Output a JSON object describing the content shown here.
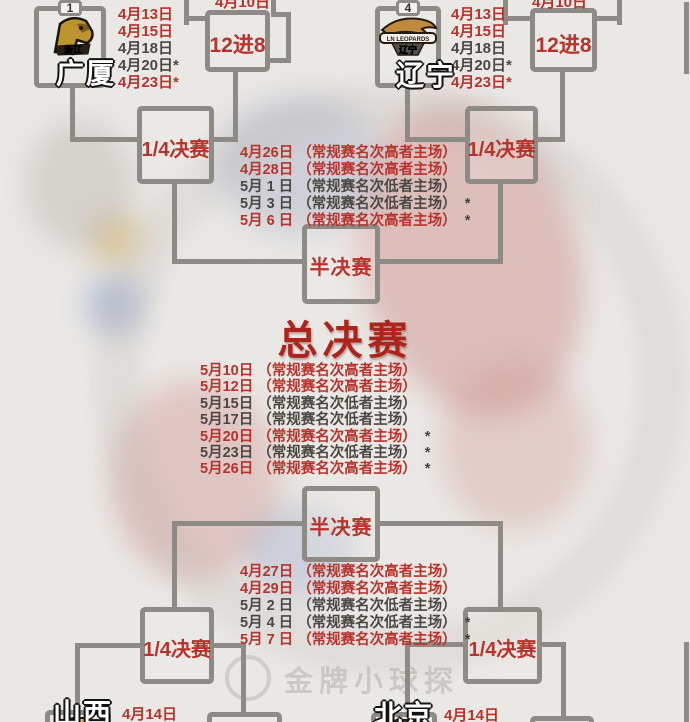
{
  "colors": {
    "red": "#b7332b",
    "dark": "#4b4743",
    "line": "#8e8a85",
    "bg": "#eae8e5",
    "final_red": "#ad241c"
  },
  "rounds": {
    "r12": "12进8",
    "qf": "1/4决赛",
    "sf": "半决赛",
    "final": "总决赛"
  },
  "top_left": {
    "seed": "1",
    "team": "广厦",
    "logo_text": "浙江",
    "clipped_date": "4月10日",
    "dates": [
      {
        "text": "4月13日",
        "cls": "red"
      },
      {
        "text": "4月15日",
        "cls": "red"
      },
      {
        "text": "4月18日",
        "cls": "dark"
      },
      {
        "text": "4月20日*",
        "cls": "dark"
      },
      {
        "text": "4月23日*",
        "cls": "red"
      }
    ]
  },
  "top_right": {
    "seed": "4",
    "team": "辽宁",
    "logo_banner": "LN LEOPARDS",
    "logo_text": "辽宁",
    "clipped_date": "4月10日",
    "dates": [
      {
        "text": "4月13日",
        "cls": "red"
      },
      {
        "text": "4月15日",
        "cls": "red"
      },
      {
        "text": "4月18日",
        "cls": "dark"
      },
      {
        "text": "4月20日*",
        "cls": "dark"
      },
      {
        "text": "4月23日*",
        "cls": "red"
      }
    ]
  },
  "semifinal_top": {
    "schedule": [
      {
        "date": "4月26日",
        "venue": "（常规赛名次高者主场）",
        "star": "",
        "cls": "red"
      },
      {
        "date": "4月28日",
        "venue": "（常规赛名次高者主场）",
        "star": "",
        "cls": "red"
      },
      {
        "date": "5月 1 日",
        "venue": "（常规赛名次低者主场）",
        "star": "",
        "cls": "dark"
      },
      {
        "date": "5月 3 日",
        "venue": "（常规赛名次低者主场）",
        "star": "*",
        "cls": "dark"
      },
      {
        "date": "5月 6 日",
        "venue": "（常规赛名次高者主场）",
        "star": "*",
        "cls": "red"
      }
    ]
  },
  "final": {
    "schedule": [
      {
        "date": "5月10日",
        "venue": "（常规赛名次高者主场）",
        "star": "",
        "cls": "red"
      },
      {
        "date": "5月12日",
        "venue": "（常规赛名次高者主场）",
        "star": "",
        "cls": "red"
      },
      {
        "date": "5月15日",
        "venue": "（常规赛名次低者主场）",
        "star": "",
        "cls": "dark"
      },
      {
        "date": "5月17日",
        "venue": "（常规赛名次低者主场）",
        "star": "",
        "cls": "dark"
      },
      {
        "date": "5月20日",
        "venue": "（常规赛名次高者主场）",
        "star": "*",
        "cls": "red"
      },
      {
        "date": "5月23日",
        "venue": "（常规赛名次低者主场）",
        "star": "*",
        "cls": "dark"
      },
      {
        "date": "5月26日",
        "venue": "（常规赛名次高者主场）",
        "star": "*",
        "cls": "red"
      }
    ]
  },
  "semifinal_bottom": {
    "schedule": [
      {
        "date": "4月27日",
        "venue": "（常规赛名次高者主场）",
        "star": "",
        "cls": "red"
      },
      {
        "date": "4月29日",
        "venue": "（常规赛名次高者主场）",
        "star": "",
        "cls": "red"
      },
      {
        "date": "5月 2 日",
        "venue": "（常规赛名次低者主场）",
        "star": "",
        "cls": "dark"
      },
      {
        "date": "5月 4 日",
        "venue": "（常规赛名次低者主场）",
        "star": "*",
        "cls": "dark"
      },
      {
        "date": "5月 7 日",
        "venue": "（常规赛名次高者主场）",
        "star": "*",
        "cls": "red"
      }
    ]
  },
  "bottom_left": {
    "team": "山西",
    "date": "4月14日"
  },
  "bottom_right": {
    "team": "北京",
    "date": "4月14日"
  },
  "watermark": {
    "text": "金牌小球探"
  }
}
